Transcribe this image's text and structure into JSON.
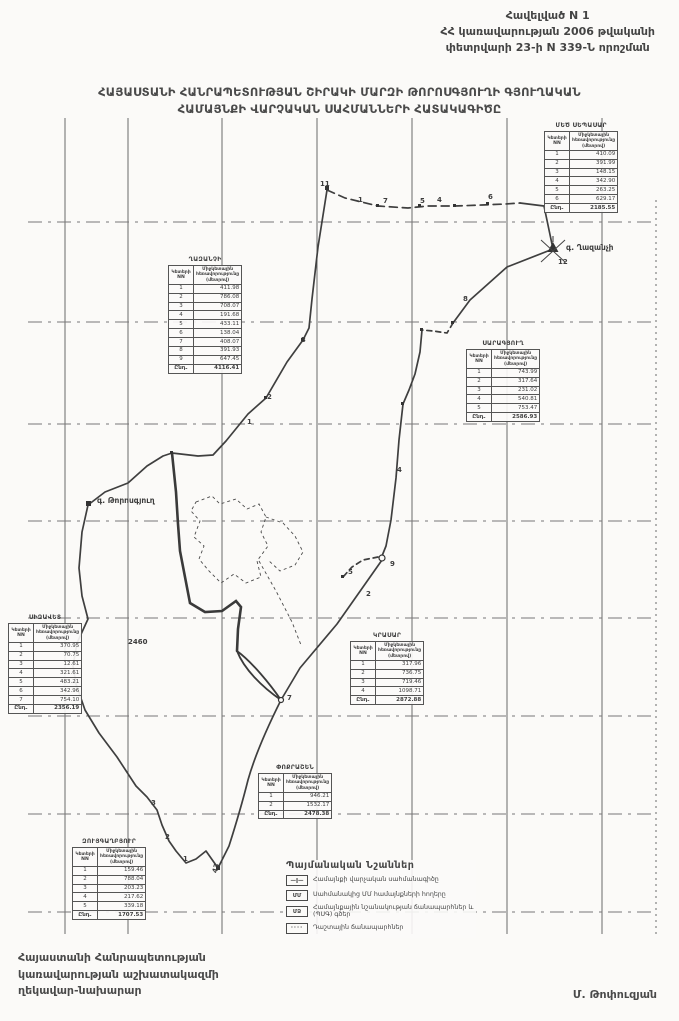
{
  "colors": {
    "paper": "#fbfaf8",
    "ink": "#3c3c3c",
    "line": "#4a4a4a"
  },
  "header": {
    "line1": "Հավելված N 1",
    "line2": "ՀՀ կառավարության 2006 թվականի",
    "line3": "փետրվարի 23-ի N 339-Ն որոշման"
  },
  "title": {
    "line1": "ՀԱՅԱՍՏԱՆԻ ՀԱՆՐԱՊԵՏՈՒԹՅԱՆ ՇԻՐԱԿԻ ՄԱՐԶԻ ԹՈՐՈՍԳՅՈՒՂԻ ԳՅՈՒՂԱԿԱՆ",
    "line2": "ՀԱՄԱՅՆՔԻ ՎԱՐՉԱԿԱՆ ՍԱՀՄԱՆՆԵՐԻ ՀԱՏԱԿԱԳԻԾԸ"
  },
  "footer": {
    "line1": "Հայաստանի Հանրապետության",
    "line2": "կառավարության աշխատակազմի",
    "line3": "ղեկավար-նախարար",
    "signature": "Մ. Թոփուզյան"
  },
  "table_headers": {
    "col1": "Կետերի NN",
    "col2": "Միջկետային հեռավորությունը (մետրով)",
    "total_label": "Ընդ."
  },
  "tables": [
    {
      "name": "ՄԵԾ ՍԵՊԱՍԱՐ",
      "rows": [
        [
          "1",
          "410.09"
        ],
        [
          "2",
          "391.99"
        ],
        [
          "3",
          "148.15"
        ],
        [
          "4",
          "342.90"
        ],
        [
          "5",
          "263.25"
        ],
        [
          "6",
          "629.17"
        ]
      ],
      "total": "2185.55"
    },
    {
      "name": "ՂԱԶԱՆՉԻ",
      "rows": [
        [
          "1",
          "411.98"
        ],
        [
          "2",
          "786.08"
        ],
        [
          "3",
          "708.07"
        ],
        [
          "4",
          "191.68"
        ],
        [
          "5",
          "433.11"
        ],
        [
          "6",
          "138.04"
        ],
        [
          "7",
          "408.07"
        ],
        [
          "8",
          "391.93"
        ],
        [
          "9",
          "647.45"
        ]
      ],
      "total": "4116.41"
    },
    {
      "name": "ՍԱՐԱԳՅՈՒՂ",
      "rows": [
        [
          "1",
          "743.99"
        ],
        [
          "2",
          "317.64"
        ],
        [
          "3",
          "231.02"
        ],
        [
          "4",
          "540.81"
        ],
        [
          "5",
          "753.47"
        ]
      ],
      "total": "2586.93"
    },
    {
      "name": "ՍԻԶԱՎԵՏ",
      "rows": [
        [
          "1",
          "370.95"
        ],
        [
          "2",
          "70.75"
        ],
        [
          "3",
          "12.61"
        ],
        [
          "4",
          "321.61"
        ],
        [
          "5",
          "483.21"
        ],
        [
          "6",
          "342.96"
        ],
        [
          "7",
          "754.10"
        ]
      ],
      "total": "2356.19"
    },
    {
      "name": "ԿՐԱՍԱՐ",
      "rows": [
        [
          "1",
          "317.96"
        ],
        [
          "2",
          "736.75"
        ],
        [
          "3",
          "719.46"
        ],
        [
          "4",
          "1098.71"
        ]
      ],
      "total": "2872.88"
    },
    {
      "name": "ՓՈՔՐԱՇԵՆ",
      "rows": [
        [
          "1",
          "946.21"
        ],
        [
          "2",
          "1532.17"
        ]
      ],
      "total": "2478.38"
    },
    {
      "name": "ԶՈՒՅԳԱՂԲՅՈՒՐ",
      "rows": [
        [
          "1",
          "159.46"
        ],
        [
          "2",
          "788.04"
        ],
        [
          "3",
          "203.23"
        ],
        [
          "4",
          "217.62"
        ],
        [
          "5",
          "339.18"
        ]
      ],
      "total": "1707.53"
    }
  ],
  "legend": {
    "title": "Պայմանական Նշաններ",
    "items": [
      {
        "mark": "—ǀ—",
        "style": "boundary",
        "label": "Համայնքի վարչական սահմանագիծը"
      },
      {
        "mark": "ՄՄ",
        "style": "mm",
        "label": "Սահմանակից ՄՄ համայնքների հողերը"
      },
      {
        "mark": "ՄՁ",
        "style": "mz",
        "label": "Համայնքային նշանակության ճանապարհներ և (ՊՍԳ) գծեր"
      },
      {
        "mark": "····",
        "style": "dots",
        "label": "Դաշտային ճանապարհներ"
      }
    ]
  },
  "map_labels": [
    {
      "t": "11",
      "x": 320,
      "y": 180
    },
    {
      "t": "1",
      "x": 358,
      "y": 196
    },
    {
      "t": "7",
      "x": 383,
      "y": 197
    },
    {
      "t": "5",
      "x": 420,
      "y": 197
    },
    {
      "t": "4",
      "x": 437,
      "y": 196
    },
    {
      "t": "6",
      "x": 488,
      "y": 193
    },
    {
      "t": "12",
      "x": 558,
      "y": 258
    },
    {
      "t": "8",
      "x": 463,
      "y": 295
    },
    {
      "t": "3",
      "x": 301,
      "y": 336
    },
    {
      "t": "2",
      "x": 267,
      "y": 393
    },
    {
      "t": "1",
      "x": 247,
      "y": 418
    },
    {
      "t": "4",
      "x": 397,
      "y": 466
    },
    {
      "t": "9",
      "x": 390,
      "y": 560
    },
    {
      "t": "5",
      "x": 348,
      "y": 568
    },
    {
      "t": "2",
      "x": 366,
      "y": 590
    },
    {
      "t": "7",
      "x": 287,
      "y": 694
    },
    {
      "t": "3",
      "x": 151,
      "y": 799
    },
    {
      "t": "2",
      "x": 165,
      "y": 833
    },
    {
      "t": "1",
      "x": 183,
      "y": 855
    },
    {
      "t": "43",
      "x": 211,
      "y": 872,
      "r": -75
    },
    {
      "t": "2460",
      "x": 128,
      "y": 638
    },
    {
      "t": "գ. Թորոսգյուղ",
      "x": 97,
      "y": 496,
      "cls": "name"
    },
    {
      "t": "գ. Ղազանչի",
      "x": 566,
      "y": 243,
      "cls": "name"
    }
  ]
}
